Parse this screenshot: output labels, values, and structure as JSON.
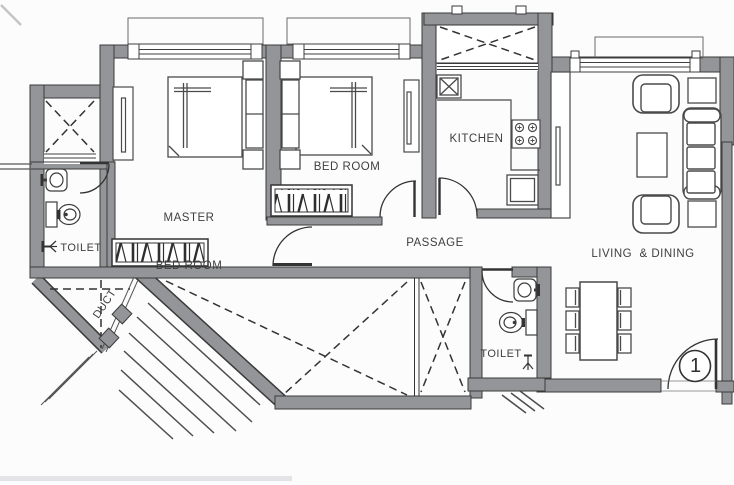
{
  "plan": {
    "title": "2BHK apartment floor plan",
    "labels": {
      "master_bedroom_line1": "MASTER",
      "master_bedroom_line2": "BED ROOM",
      "bedroom": "BED ROOM",
      "kitchen": "KITCHEN",
      "passage": "PASSAGE",
      "living_dining": "LIVING  & DINING",
      "toilet_left": "TOILET",
      "toilet_right": "TOILET",
      "duct": "DUCT"
    },
    "entry": {
      "door_number": "1"
    },
    "colors": {
      "wall_fill": "#949598",
      "wall_edge": "#3a3a3a",
      "line": "#2f2f2f",
      "background": "#fcfcfc"
    }
  }
}
